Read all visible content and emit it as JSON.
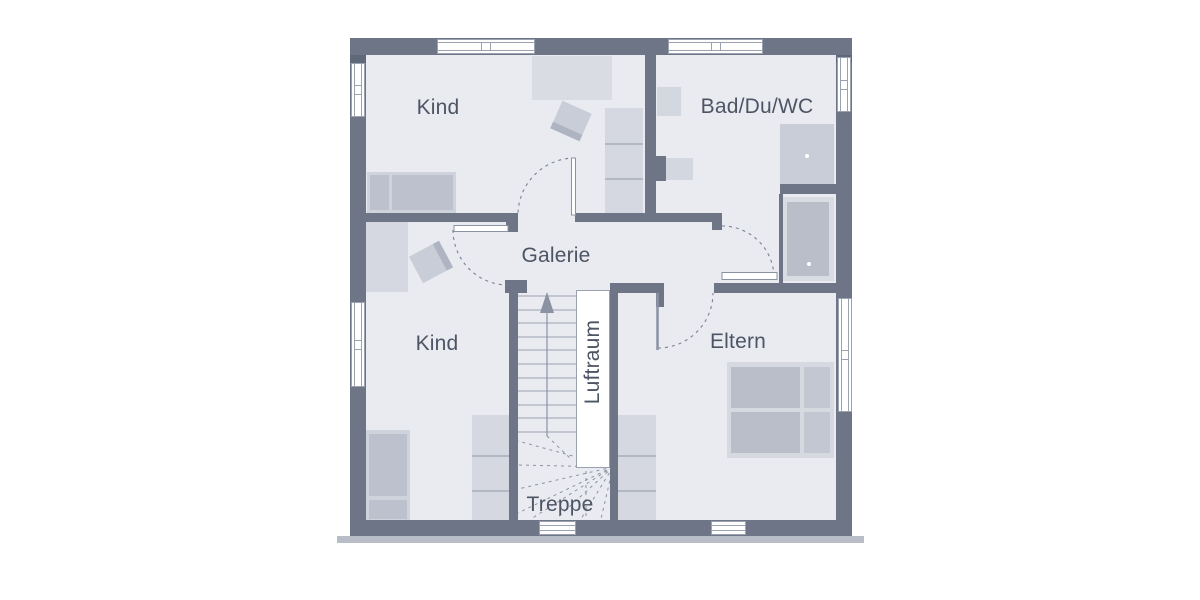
{
  "floorplan": {
    "title": "Obergeschoss Grundriss",
    "rooms": {
      "kind_top": "Kind",
      "bath": "Bad/Du/WC",
      "galerie": "Galerie",
      "kind_bottom": "Kind",
      "eltern": "Eltern",
      "luftraum": "Luftraum",
      "treppe": "Treppe"
    },
    "icons": {
      "stairs_direction": "up-arrow"
    },
    "colors": {
      "wall": "#6d7587",
      "floor": "#e9ebf1",
      "furniture_light": "#d5d8e0",
      "furniture_dark": "#bcc1cd",
      "line": "#8b93a3",
      "label_text": "#4d5464",
      "window_fill": "#ffffff",
      "plinth_shadow": "#b8bdc8"
    }
  }
}
